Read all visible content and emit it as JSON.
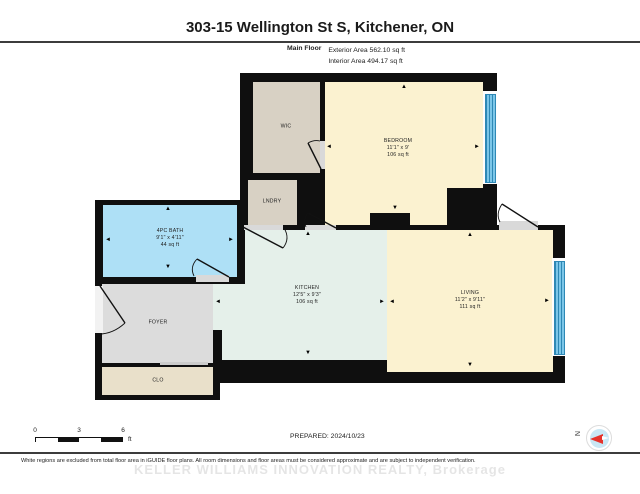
{
  "header": {
    "title": "303-15 Wellington St S, Kitchener, ON",
    "floor_label": "Main Floor",
    "exterior_area": "Exterior Area 562.10 sq ft",
    "interior_area": "Interior Area 494.17 sq ft"
  },
  "rooms": {
    "wic": {
      "name": "WIC"
    },
    "lndry": {
      "name": "LNDRY"
    },
    "bedroom": {
      "name": "BEDROOM",
      "dims": "11'1\" x 9'",
      "area": "106 sq ft"
    },
    "bath": {
      "name": "4PC BATH",
      "dims": "9'1\" x 4'11\"",
      "area": "44 sq ft"
    },
    "foyer": {
      "name": "FOYER"
    },
    "clo": {
      "name": "CLO"
    },
    "kitchen": {
      "name": "KITCHEN",
      "dims": "12'5\" x 9'3\"",
      "area": "106 sq ft"
    },
    "living": {
      "name": "LIVING",
      "dims": "11'2\" x 9'11\"",
      "area": "111 sq ft"
    }
  },
  "icons": {
    "arrow_up": "▲",
    "arrow_down": "▼",
    "arrow_left": "◄",
    "arrow_right": "►",
    "compass_north": "N"
  },
  "scale_bar": {
    "start": "0",
    "mid": "3",
    "end": "6",
    "unit": "ft"
  },
  "footer": {
    "prepared": "PREPARED: 2024/10/23",
    "disclaimer": "White regions are excluded from total floor area in iGUIDE floor plans. All room dimensions and floor areas must be considered approximate and are subject to independent verification.",
    "watermark": "KELLER WILLIAMS INNOVATION REALTY, Brokerage"
  },
  "colors": {
    "wall": "#0f0f0f",
    "bedroom_living": "#fbf2d0",
    "closet_beige": "#d8d1c4",
    "clo_beige": "#e9e0ca",
    "bath_blue": "#aee0f6",
    "kitchen_mint": "#e5f0ea",
    "foyer_gray": "#dcdcdc",
    "window_blue": "#5fb6e0"
  }
}
